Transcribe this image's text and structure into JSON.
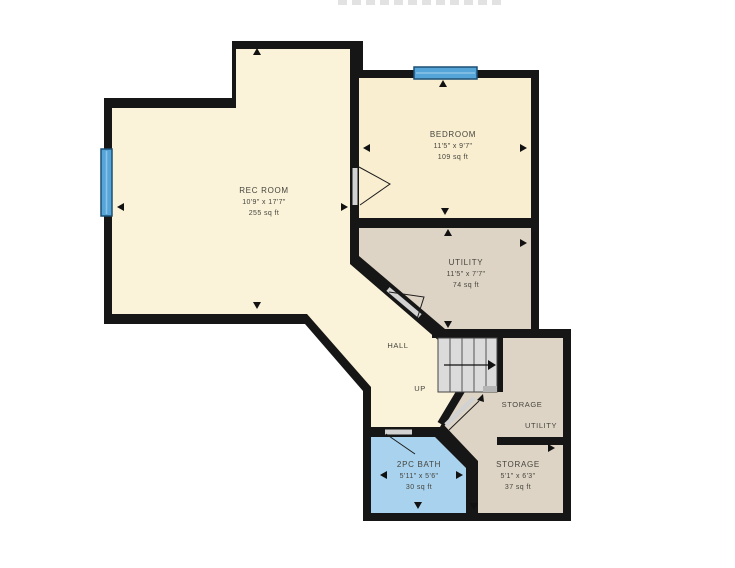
{
  "floorplan": {
    "rec_room": {
      "name": "REC ROOM",
      "dims": "10'9\" x 17'7\"",
      "area": "255 sq ft"
    },
    "bedroom": {
      "name": "BEDROOM",
      "dims": "11'5\" x 9'7\"",
      "area": "109 sq ft"
    },
    "utility": {
      "name": "UTILITY",
      "dims": "11'5\" x 7'7\"",
      "area": "74 sq ft"
    },
    "hall": {
      "name": "HALL"
    },
    "stairs": {
      "label": "UP"
    },
    "storage_closet": {
      "name": "STORAGE",
      "sub_label": "UTILITY"
    },
    "bath": {
      "name": "2PC BATH",
      "dims": "5'11\" x 5'6\"",
      "area": "30 sq ft"
    },
    "storage": {
      "name": "STORAGE",
      "dims": "5'1\" x 6'3\"",
      "area": "37 sq ft"
    }
  },
  "colors": {
    "wall": "#161616",
    "room_cream": "#FAF2D9",
    "room_bedroom": "#F9EED0",
    "room_tan": "#DED4C5",
    "room_bath": "#A9D2EE",
    "stairs_fill": "#DBDBDB",
    "window_fill": "#56A5D8",
    "arrow": "#111111",
    "label": "#45453D"
  }
}
